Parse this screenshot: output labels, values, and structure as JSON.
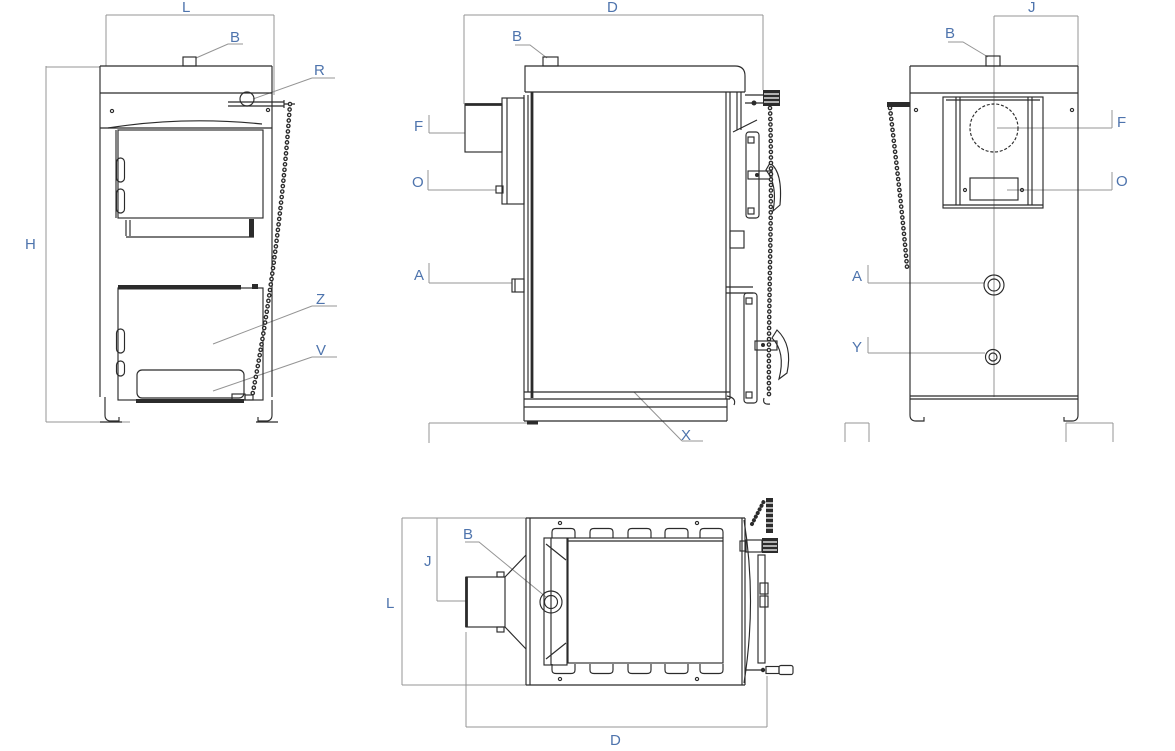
{
  "drawing": {
    "subject": "solid-fuel boiler dimensional drawing, four orthographic views",
    "colors": {
      "background": "#ffffff",
      "line": "#2b2b2b",
      "dimension_line": "#949494",
      "label": "#4e74ad"
    },
    "views": {
      "front": {
        "labels": [
          {
            "id": "L",
            "text": "L"
          },
          {
            "id": "B",
            "text": "B"
          },
          {
            "id": "R",
            "text": "R"
          },
          {
            "id": "H",
            "text": "H"
          },
          {
            "id": "Z",
            "text": "Z"
          },
          {
            "id": "V",
            "text": "V"
          }
        ]
      },
      "side": {
        "labels": [
          {
            "id": "D",
            "text": "D"
          },
          {
            "id": "B",
            "text": "B"
          },
          {
            "id": "F",
            "text": "F"
          },
          {
            "id": "O",
            "text": "O"
          },
          {
            "id": "A",
            "text": "A"
          },
          {
            "id": "X",
            "text": "X"
          }
        ]
      },
      "rear": {
        "labels": [
          {
            "id": "J",
            "text": "J"
          },
          {
            "id": "B",
            "text": "B"
          },
          {
            "id": "F",
            "text": "F"
          },
          {
            "id": "O",
            "text": "O"
          },
          {
            "id": "A",
            "text": "A"
          },
          {
            "id": "Y",
            "text": "Y"
          }
        ]
      },
      "top": {
        "labels": [
          {
            "id": "J",
            "text": "J"
          },
          {
            "id": "B",
            "text": "B"
          },
          {
            "id": "L",
            "text": "L"
          },
          {
            "id": "D",
            "text": "D"
          }
        ]
      }
    }
  }
}
